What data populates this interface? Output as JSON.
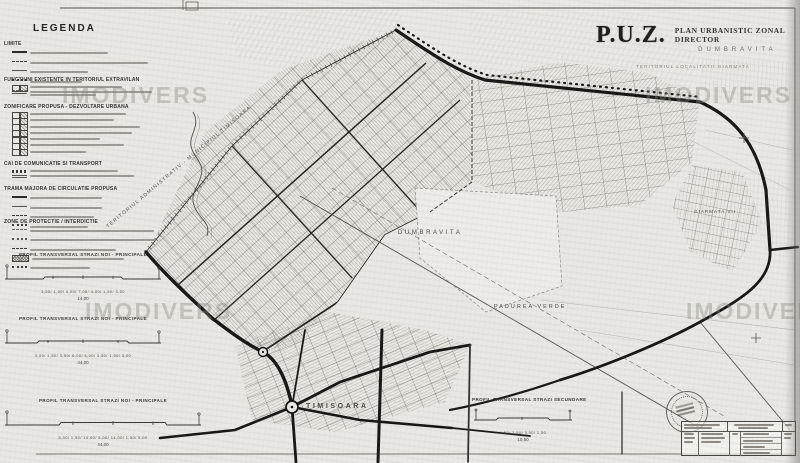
{
  "header": {
    "puz": "P.U.Z.",
    "plan_type": "PLAN URBANISTIC ZONAL DIRECTOR",
    "locality": "DUMBRAVITA",
    "territory_note": "TERITORIUL LOCALITATII GIARMATA"
  },
  "legend": {
    "title": "LEGENDA",
    "sections": [
      {
        "heading": "LIMITE"
      },
      {
        "heading": "FUNCTIUNI EXISTENTE IN TERITORIUL EXTRAVILAN"
      },
      {
        "heading": "ZONIFICARE PROPUSA - DEZVOLTARE URBANA"
      },
      {
        "heading": "CAI DE COMUNICATIE SI TRANSPORT"
      },
      {
        "heading": "TRAMA MAJORA DE CIRCULATIE PROPUSA"
      },
      {
        "heading": "ZONE DE PROTECTIE / INTERDICTIE"
      }
    ]
  },
  "map_labels": {
    "admin_boundary": "TERITORIUL ADMINISTRATIV - MUNICIPIUL TIMISOARA",
    "dumbravita": "DUMBRAVITA",
    "padurea_verde": "PADUREA VERDE",
    "timisoara": "TIMISOARA",
    "giarmata_vii": "GIARMATA VII"
  },
  "profiles": [
    {
      "heading": "PROFIL TRANSVERSAL STRAZI NOI - PRINCIPALE",
      "dims": "3,50/ 1,50/ 4,00/ 7,00/ 4,00/ 1,50/ 3,50",
      "total": "14,00"
    },
    {
      "heading": "PROFIL TRANSVERSAL STRAZI NOI - PRINCIPALE",
      "dims": "3,00/ 1,50/ 3,50/ 6,00/ 6,00/ 3,50/ 1,50/ 3,00",
      "total": "44,00"
    },
    {
      "heading": "PROFIL TRANSVERSAL STRAZI NOI - PRINCIPALE",
      "dims": "5,00/ 1,50/ 14,00/ 5,00/ 14,00/ 1,50/ 5,00",
      "total": "44,00"
    },
    {
      "heading": "PROFIL TRANSVERSAL STRAZI SECUNDARE",
      "dims": "1,50/ 3,50/ 3,50/ 1,50",
      "total": "10,50"
    }
  ],
  "watermark": {
    "text": "IMODIVERS"
  },
  "colors": {
    "ink": "#1c1c1a",
    "paper": "#e9e8e4",
    "texture": "#8d8b86",
    "watermark": "#868683"
  }
}
